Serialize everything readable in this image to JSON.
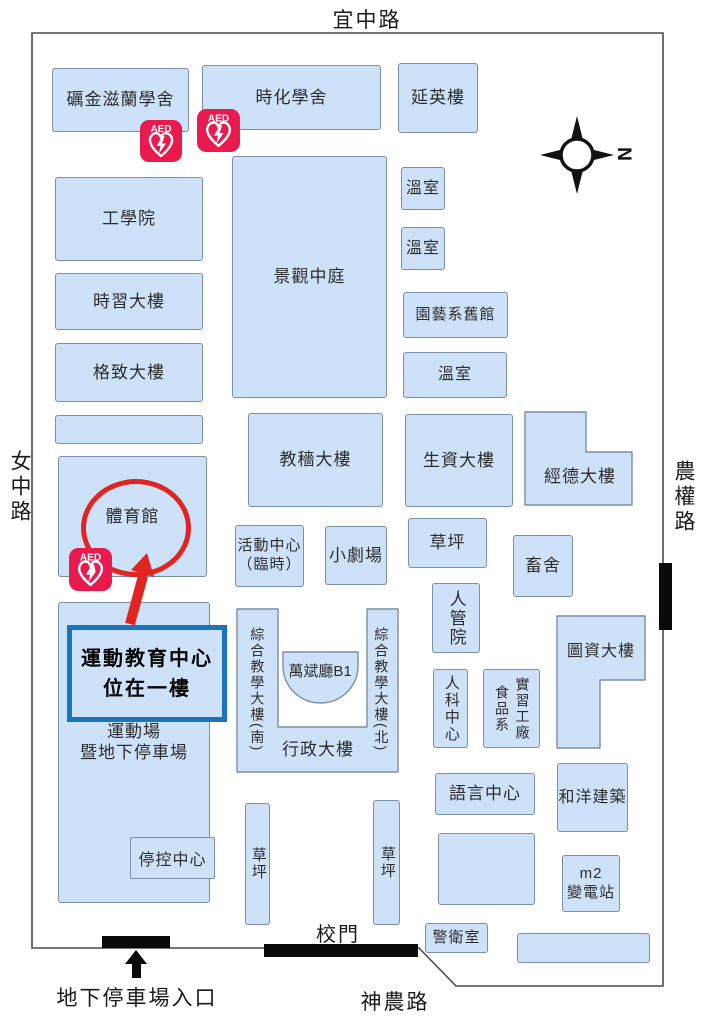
{
  "roads": {
    "top": "宜中路",
    "left": "女中路",
    "right": "農權路",
    "bottom": "神農路"
  },
  "gates": {
    "main_gate": "校門",
    "parking_entrance": "地下停車場入口"
  },
  "compass": {
    "north": "N"
  },
  "aed": {
    "label": "AED"
  },
  "annotation": {
    "line1": "運動教育中心",
    "line2": "位在一樓"
  },
  "buildings": {
    "lijin_zilan_dorm": "礪金滋蘭學舍",
    "shihua_dorm": "時化學舍",
    "yanying": "延英樓",
    "engineering": "工學院",
    "shixi": "時習大樓",
    "gezhi": "格致大樓",
    "landscape_court": "景觀中庭",
    "greenhouse1": "溫室",
    "greenhouse2": "溫室",
    "greenhouse3": "溫室",
    "horticulture_old": "園藝系舊館",
    "jiaose": "教穡大樓",
    "shengzi": "生資大樓",
    "jingde": "經德大樓",
    "gym": "體育館",
    "activity_center_line1": "活動中心",
    "activity_center_line2": "（臨時）",
    "small_theater": "小劇場",
    "lawn_center": "草坪",
    "livestock": "畜舍",
    "renguan": "人管院",
    "tuzi": "圖資大樓",
    "comprehensive_south": "綜合教學大樓(南)",
    "comprehensive_north": "綜合教學大樓(北)",
    "wanbin_hall": "萬斌廳B1",
    "admin": "行政大樓",
    "renke": "人科中心",
    "food_dept": "食品系",
    "practice_factory": "實習工廠",
    "sports_field_line1": "運動場",
    "sports_field_line2": "暨地下停車場",
    "parking_control": "停控中心",
    "lawn_left": "草坪",
    "lawn_right": "草坪",
    "language_center": "語言中心",
    "heyang": "和洋建築",
    "substation_line1": "m2",
    "substation_line2": "變電站",
    "guard": "警衛室"
  },
  "colors": {
    "building_fill": "#cde1f8",
    "building_border": "#7b8fa6",
    "annotation_red": "#e02420",
    "annotation_blue": "#1c75bb",
    "aed_red": "#ea1a4e",
    "gate_black": "#0a0a0a"
  }
}
